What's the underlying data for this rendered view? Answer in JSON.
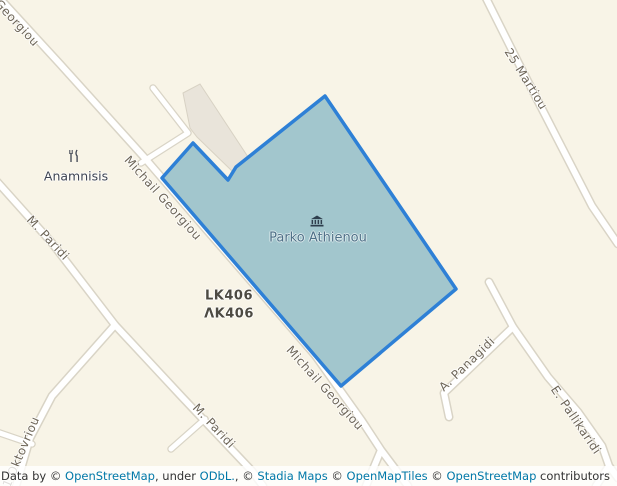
{
  "map": {
    "park": {
      "name": "Parko Athienou",
      "fill_color": "#a2c6cd",
      "border_color": "#2e80d6",
      "museum_icon": "museum-icon"
    },
    "poi": {
      "restaurant_name": "Anamnisis",
      "restaurant_icon": "restaurant-icon"
    },
    "road_labels": {
      "georgiou": "Georgiou",
      "michail_georgiou": "Michail Georgiou",
      "m_paridi": "M. Paridi",
      "oktovriou": "1 Oktovriou",
      "martiou_25": "25 Martiou",
      "panagidi": "A. Panagidi",
      "pallikaridi": "E. Pallikaridi"
    },
    "ref_labels": {
      "latin": "LK406",
      "greek": "ΛΚ406"
    },
    "colors": {
      "land": "#f8f4e7",
      "road_fill": "#ffffff",
      "road_casing": "#d9d4c6",
      "building_fill": "#e9e4da",
      "building_stroke": "#d8d2c4",
      "street_label": "#6e6658",
      "link_blue": "#0078a8"
    }
  },
  "attribution": {
    "parts": [
      {
        "t": "Leaflet",
        "link": true
      },
      {
        "t": " | Data by © ",
        "link": false
      },
      {
        "t": "OpenStreetMap",
        "link": true
      },
      {
        "t": ", under ",
        "link": false
      },
      {
        "t": "ODbL.",
        "link": true
      },
      {
        "t": ", © ",
        "link": false
      },
      {
        "t": "Stadia Maps",
        "link": true
      },
      {
        "t": " © ",
        "link": false
      },
      {
        "t": "OpenMapTiles",
        "link": true
      },
      {
        "t": " © ",
        "link": false
      },
      {
        "t": "OpenStreetMap",
        "link": true
      },
      {
        "t": " contributors",
        "link": false
      }
    ]
  }
}
